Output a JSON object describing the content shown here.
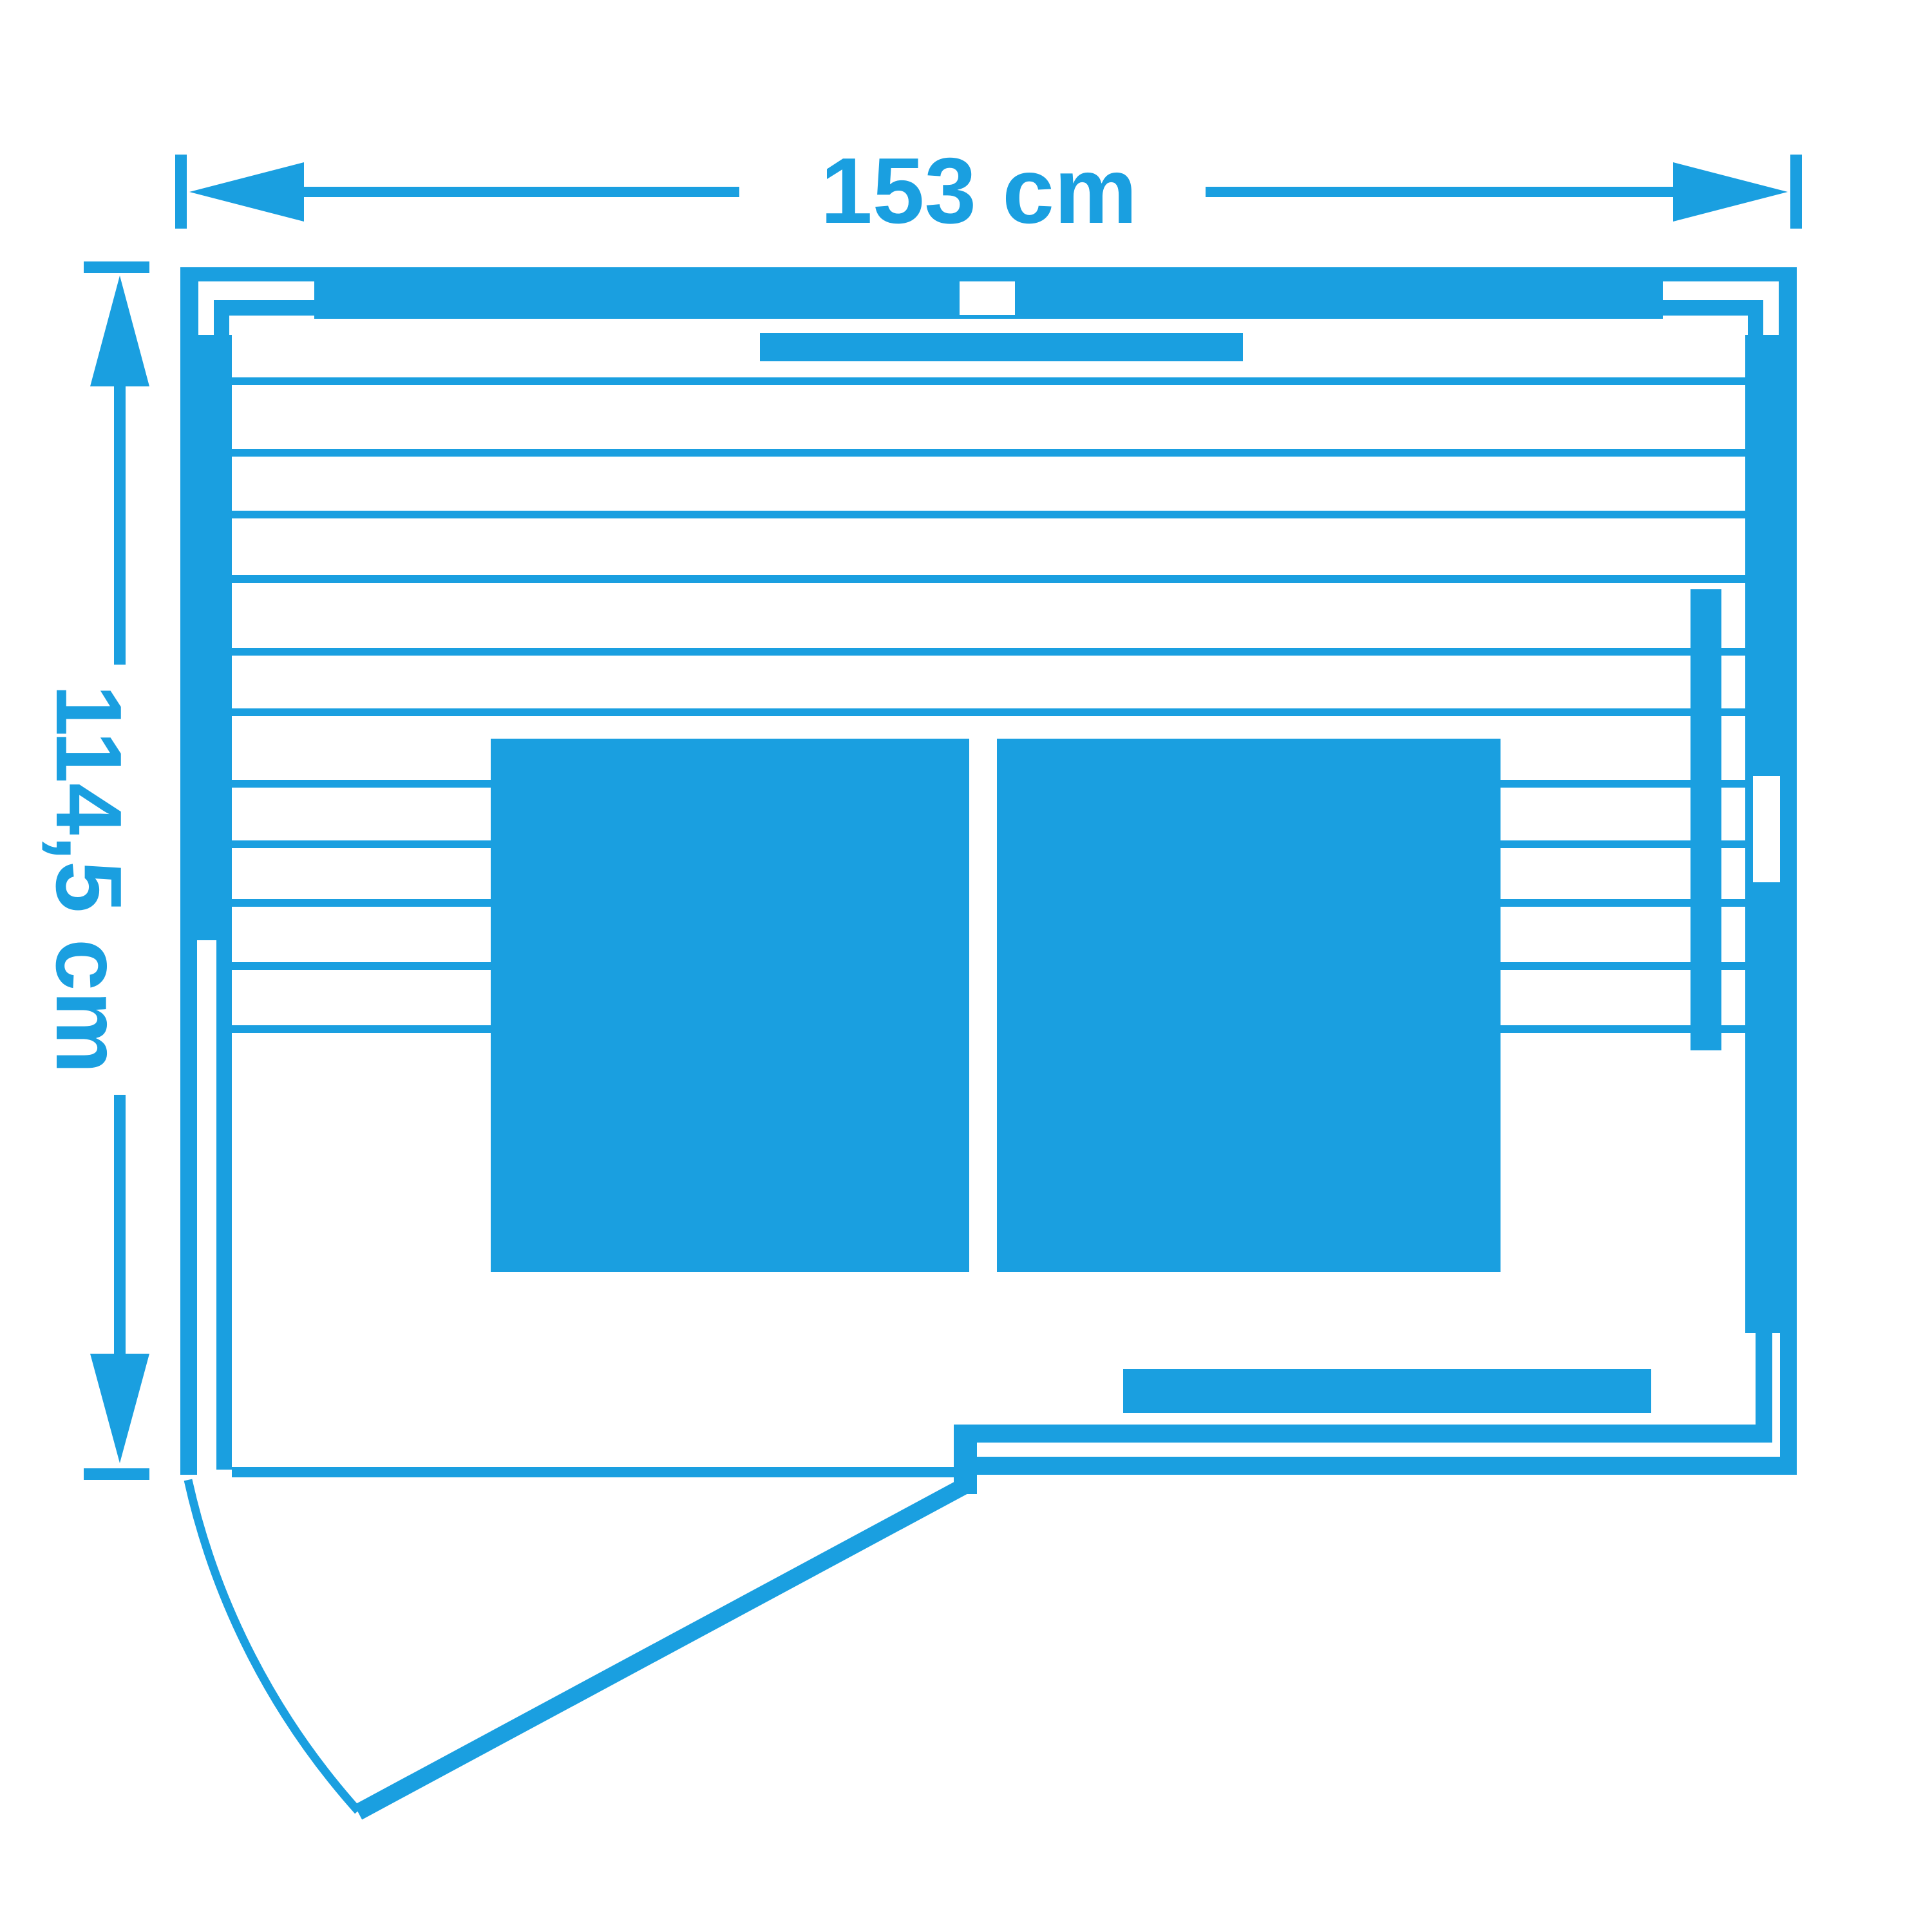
{
  "colors": {
    "accent": "#1A9FE0",
    "background": "#FFFFFF"
  },
  "labels": {
    "width": "153 cm",
    "height": "114,5 cm"
  }
}
